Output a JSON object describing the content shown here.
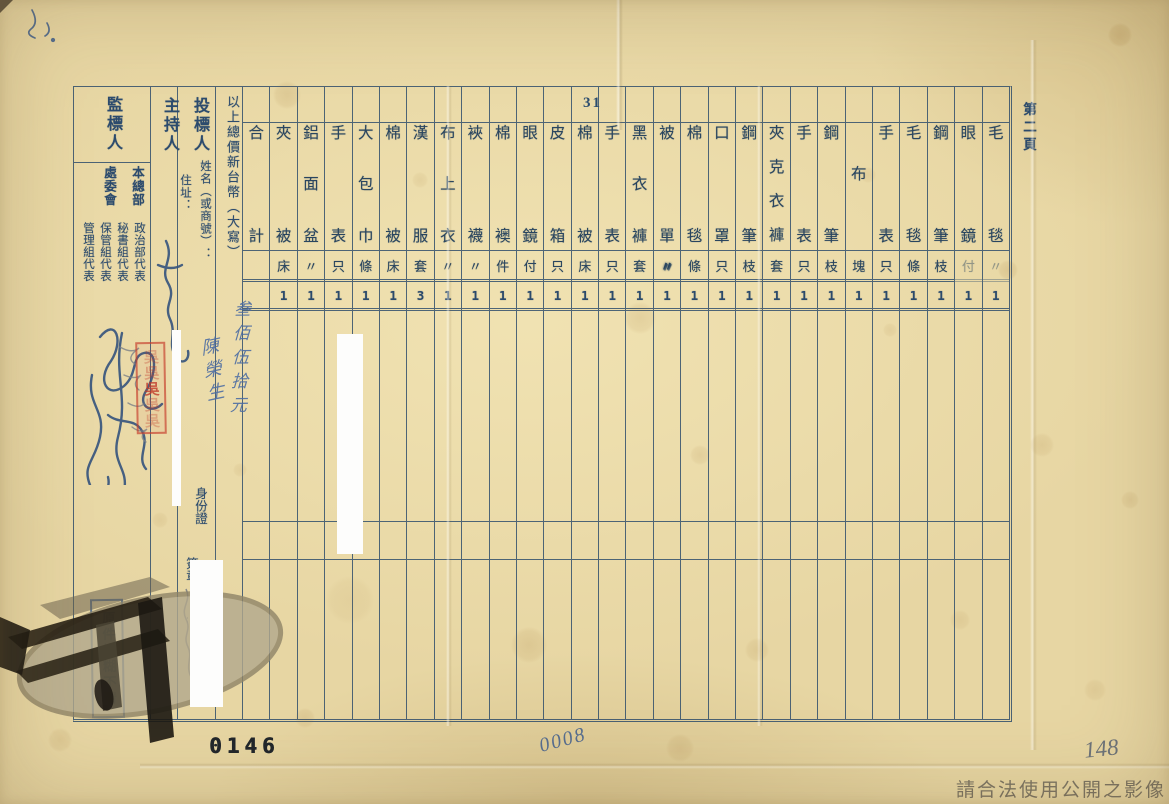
{
  "page": {
    "sheet_number": "31",
    "page_label": "第二頁",
    "serial_number": "0146",
    "hand_number": "0008",
    "corner_number": "148",
    "watermark": "請合法使用公開之影像"
  },
  "left": {
    "supervisor_label": "監標人",
    "host_label": "主持人",
    "bidder_label": "投標人",
    "name_label": "姓名（或商號）：",
    "address_label": "住址：",
    "id_label": "身份證",
    "seal_label": "簽章",
    "total_label": "以上總價新台幣（大寫）",
    "org_groups": [
      {
        "org": "本總部",
        "reps": [
          "政治部代表",
          "秘書組代表",
          "保管組代表"
        ]
      },
      {
        "org": "處委會",
        "reps": [
          "管理組代表"
        ]
      }
    ],
    "handwriting": {
      "bidder_name": "陳榮生",
      "total_amount": "叁佰伍拾元"
    },
    "stamps": {
      "blur_notice": "原件模糊不清",
      "red_seal_char": "吳"
    }
  },
  "table": {
    "total_column": "合計",
    "columns": [
      {
        "name": "夾被",
        "unit": "床",
        "qty": "1"
      },
      {
        "name": "鋁面盆",
        "unit": "〃",
        "qty": "1"
      },
      {
        "name": "手表",
        "unit": "只",
        "qty": "1"
      },
      {
        "name": "大包巾",
        "unit": "條",
        "qty": "1"
      },
      {
        "name": "棉被",
        "unit": "床",
        "qty": "1"
      },
      {
        "name": "漢服",
        "unit": "套",
        "qty": "3"
      },
      {
        "name": "布上衣",
        "unit": "〃",
        "qty": "1"
      },
      {
        "name": "裌襪",
        "unit": "〃",
        "qty": "1"
      },
      {
        "name": "棉襖",
        "unit": "件",
        "qty": "1"
      },
      {
        "name": "眼鏡",
        "unit": "付",
        "qty": "1"
      },
      {
        "name": "皮箱",
        "unit": "只",
        "qty": "1"
      },
      {
        "name": "棉被",
        "unit": "床",
        "qty": "1"
      },
      {
        "name": "手表",
        "unit": "只",
        "qty": "1"
      },
      {
        "name": "黑衣褲",
        "unit": "套",
        "qty": "1"
      },
      {
        "name": "被單",
        "unit": "〃",
        "qty": "1"
      },
      {
        "name": "棉毯",
        "unit": "條",
        "qty": "1"
      },
      {
        "name": "口罩",
        "unit": "只",
        "qty": "1"
      },
      {
        "name": "鋼筆",
        "unit": "枝",
        "qty": "1"
      },
      {
        "name": "夾克衣褲",
        "unit": "套",
        "qty": "1"
      },
      {
        "name": "手表",
        "unit": "只",
        "qty": "1"
      },
      {
        "name": "鋼筆",
        "unit": "枝",
        "qty": "1"
      },
      {
        "name": "布",
        "unit": "塊",
        "qty": "1"
      },
      {
        "name": "手表",
        "unit": "只",
        "qty": "1"
      },
      {
        "name": "毛毯",
        "unit": "條",
        "qty": "1"
      },
      {
        "name": "鋼筆",
        "unit": "枝",
        "qty": "1"
      },
      {
        "name": "眼鏡",
        "unit": "付",
        "qty": "1"
      },
      {
        "name": "毛毯",
        "unit": "〃",
        "qty": "1"
      }
    ]
  }
}
